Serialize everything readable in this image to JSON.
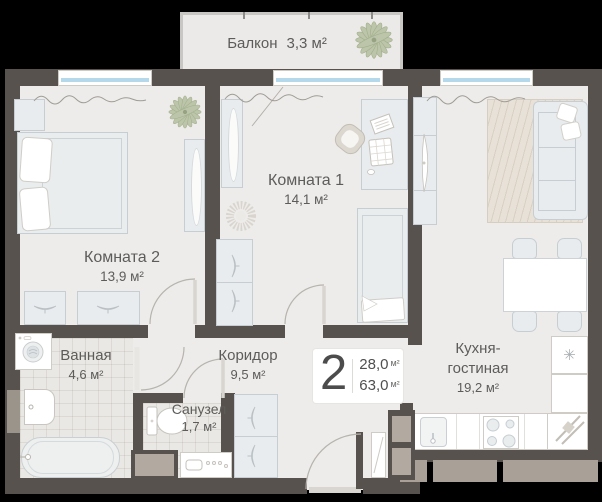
{
  "plan": {
    "balcony": {
      "name": "Балкон",
      "area": "3,3 м²"
    },
    "room1": {
      "name": "Комната 1",
      "area": "14,1 м²"
    },
    "room2": {
      "name": "Комната 2",
      "area": "13,9 м²"
    },
    "bathroom": {
      "name": "Ванная",
      "area": "4,6 м²"
    },
    "corridor": {
      "name": "Коридор",
      "area": "9,5 м²"
    },
    "wc": {
      "name": "Санузел",
      "area": "1,7 м²"
    },
    "kitchen": {
      "name": "Кухня-гостиная",
      "area": "19,2 м²"
    }
  },
  "badge": {
    "rooms_count": "2",
    "living_area": "28,0",
    "total_area": "63,0",
    "unit": "м²"
  },
  "icons": {
    "snowflake": "✳",
    "plant": "plant-flower"
  },
  "colors": {
    "wall": "#57524d",
    "floor": "#edecea",
    "window_glass": "#b5d9ea",
    "plant": "#bcc5a9",
    "rug": "#e7e1d7",
    "ledge": "#a9a098",
    "text": "#5d5c5a"
  }
}
